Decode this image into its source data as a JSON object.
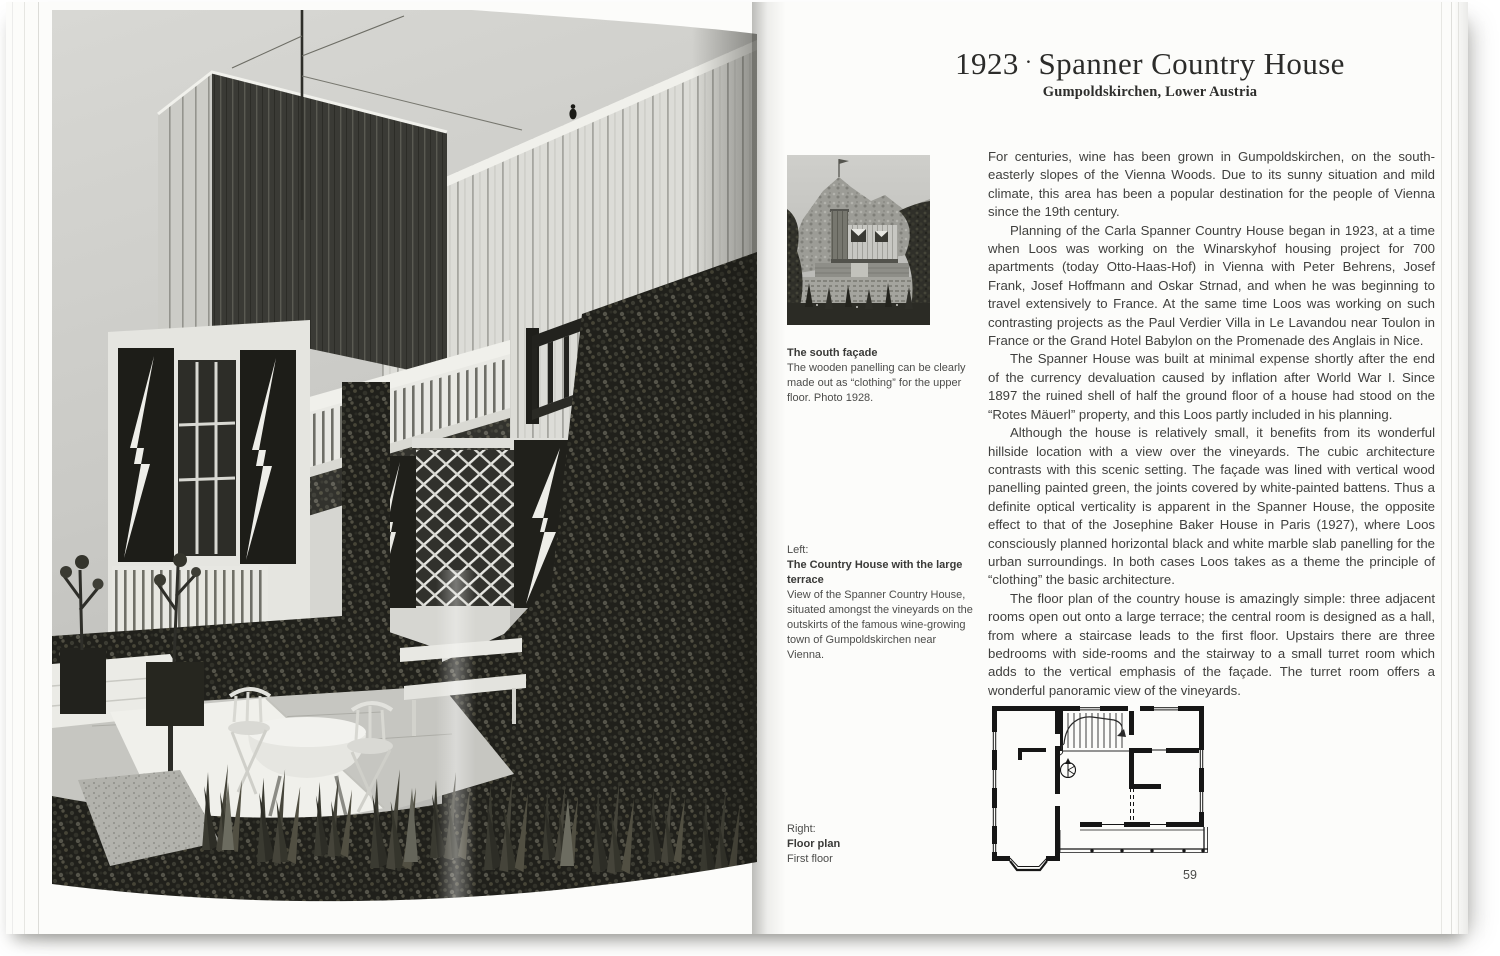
{
  "book": {
    "header": {
      "year": "1923",
      "separator": "·",
      "title": "Spanner Country House",
      "subtitle": "Gumpoldskirchen, Lower Austria"
    },
    "body_paragraphs": [
      "For centuries, wine has been grown in Gumpoldskirchen, on the south-easterly slopes of the Vienna Woods. Due to its sunny situation and mild climate, this area has been a popular destination for the people of Vienna since the 19th century.",
      "Planning of the Carla Spanner Country House began in 1923, at a time when Loos was working on the Winarskyhof housing project for 700 apartments (today Otto-Haas-Hof) in Vienna with Peter Behrens, Josef Frank, Josef Hoffmann and Oskar Strnad, and when he was beginning to travel extensively to France. At the same time Loos was working on such contrasting projects as the Paul Verdier Villa in Le Lavandou near Toulon in France or the Grand Hotel Babylon on the Promenade des Anglais in Nice.",
      "The Spanner House was built at minimal expense shortly after the end of the currency devaluation caused by inflation after World War I. Since 1897 the ruined shell of half the ground floor of a house had stood on the “Rotes Mäuerl” property, and this Loos partly included in his planning.",
      "Although the house is relatively small, it benefits from its wonderful hillside location with a view over the vineyards. The cubic architecture contrasts with this scenic setting. The façade was lined with vertical wood panelling painted green, the joints covered by white-painted battens. Thus a definite optical verticality is apparent in the Spanner House, the opposite effect to that of the Josephine Baker House in Paris (1927), where Loos consciously planned horizontal black and white marble slab panelling for the urban surroundings. In both cases Loos takes as a theme the principle of “clothing” the basic architecture.",
      "The floor plan of the country house is amazingly simple: three adjacent rooms open out onto a large terrace; the central room is designed as a hall, from where a staircase leads to the first floor. Upstairs there are three bedrooms with side-rooms and the stairway to a small turret room which adds to the vertical emphasis of the façade. The turret room offers a wonderful panoramic view of the vineyards."
    ],
    "captions": {
      "south_facade": {
        "heading": "The south façade",
        "body": "The wooden panelling can be clearly made out as “clothing” for the upper floor. Photo 1928."
      },
      "terrace": {
        "kicker": "Left:",
        "heading": "The Country House with the large terrace",
        "body": "View of the Spanner Country House, situated amongst the vineyards on the outskirts of the famous wine-growing town of Gumpoldskirchen near Vienna."
      },
      "floor_plan": {
        "kicker": "Right:",
        "heading": "Floor plan",
        "body": "First floor"
      }
    },
    "page_number": "59",
    "colors": {
      "paper": "#fcfcfa",
      "ink": "#3f3f3d",
      "photo_dark": "#22221e"
    }
  }
}
